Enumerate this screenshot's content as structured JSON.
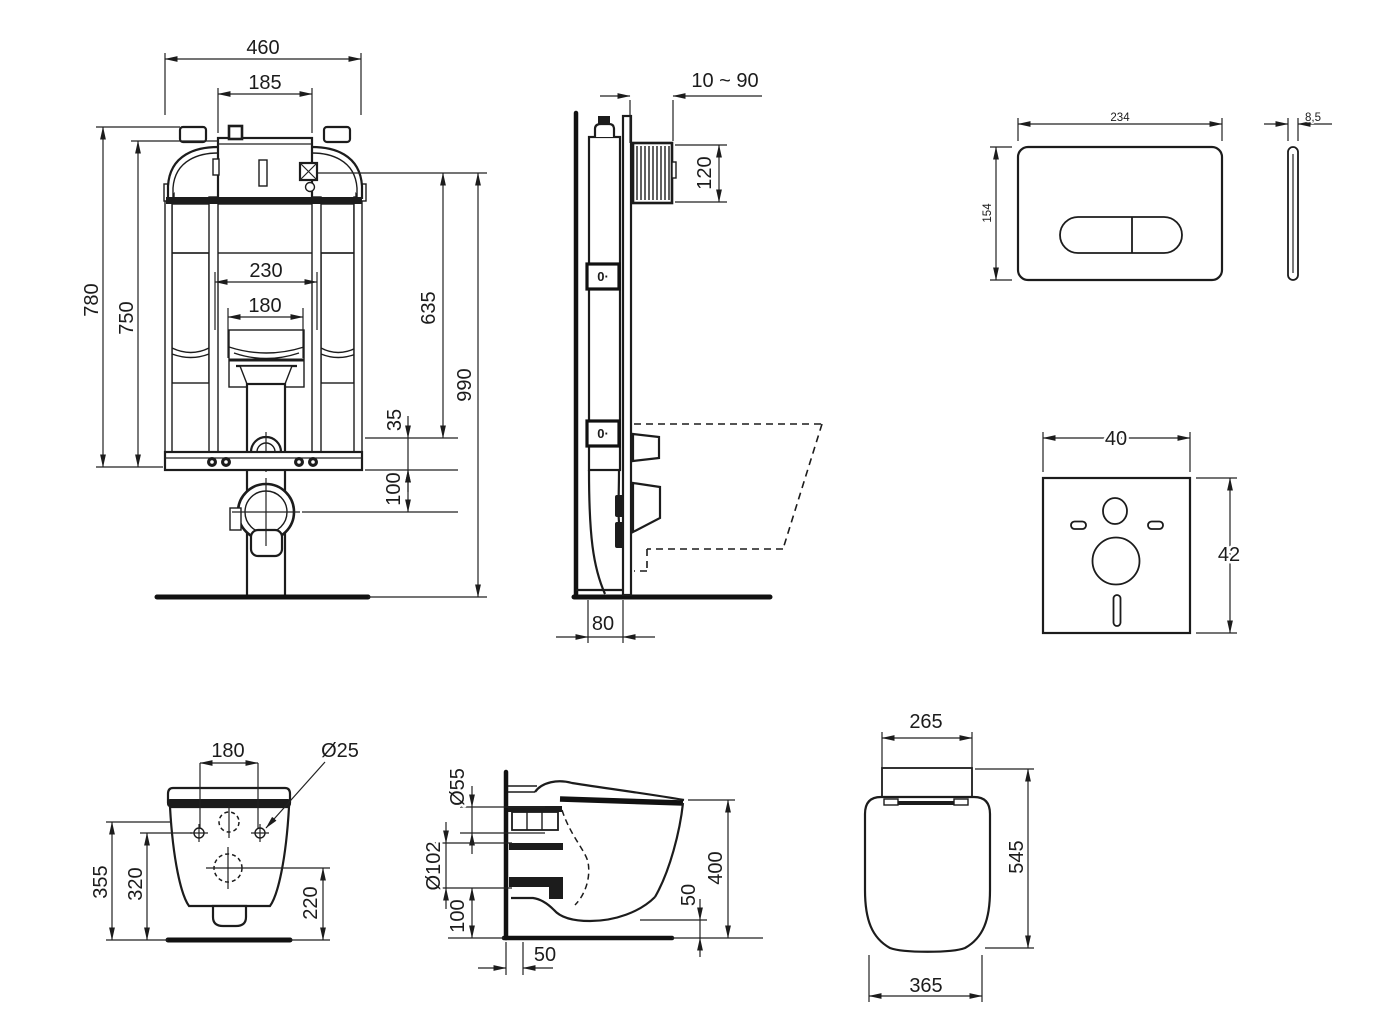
{
  "drawing": {
    "type": "technical-installation-drawing",
    "subject": "Wall-hung WC with concealed cistern frame, flush plate, sound insulation mat and seat",
    "background": "#ffffff",
    "line_color": "#1c1c1c",
    "views": {
      "cistern_front": {
        "dims": {
          "total_width": "460",
          "top_opening_width": "185",
          "frame_height": "780",
          "tank_height": "750",
          "rail_spacing": "230",
          "pipe_guide_spacing": "180",
          "valve_to_bend_height": "635",
          "bend_offset": "35",
          "total_height": "990",
          "drain_center_height": "100"
        }
      },
      "cistern_side": {
        "dims": {
          "finished_wall_range": "10 ~ 90",
          "inspection_opening_height": "120",
          "frame_depth": "80"
        },
        "fixing_marker": "0·"
      },
      "flush_plate": {
        "dims": {
          "width": "234",
          "height": "154",
          "thickness": "8,5"
        }
      },
      "sound_mat": {
        "dims": {
          "width": "40",
          "height": "42"
        }
      },
      "bowl_rear": {
        "dims": {
          "fixing_hole_spacing": "180",
          "fixing_hole_diameter": "Ø25",
          "height_to_top_hole": "355",
          "height_to_fixing_holes": "320",
          "height_to_outlet": "220"
        }
      },
      "bowl_side": {
        "dims": {
          "inlet_diameter": "Ø55",
          "outlet_diameter": "Ø102",
          "outlet_height": "100",
          "outlet_wall_distance": "50",
          "bottom_clearance": "50",
          "rim_height": "400"
        }
      },
      "seat": {
        "dims": {
          "hinge_width": "265",
          "depth": "545",
          "width": "365"
        }
      }
    }
  }
}
